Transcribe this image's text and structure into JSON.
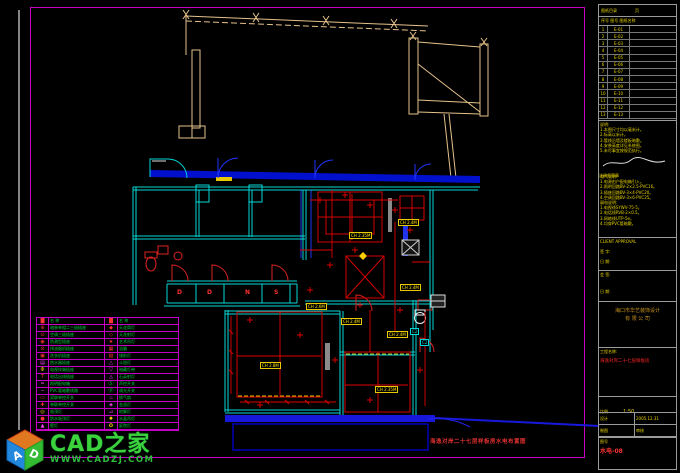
{
  "watermark": {
    "brand": "CAD之家",
    "url": "WWW.CADZJ.COM",
    "cube_letter_a": "A",
    "cube_letter_d": "D"
  },
  "drawing_title": "海逸对岸二十七层样板房水电布置图",
  "colors": {
    "frame": "#c400c4",
    "wall": "#00d8d8",
    "band": "#0010cc",
    "wiring": "#e00000",
    "label": "#ffe400",
    "legend_text": "#00cc44",
    "title_text": "#e8d400",
    "alert": "#ff2525",
    "roof": "#e6c28c"
  },
  "plan": {
    "ch_labels": [
      {
        "x": 349,
        "y": 232,
        "text": "CH 2.35M"
      },
      {
        "x": 398,
        "y": 219,
        "text": "CH 2.4M"
      },
      {
        "x": 400,
        "y": 284,
        "text": "CH 2.4M"
      },
      {
        "x": 260,
        "y": 362,
        "text": "CH 2.8M"
      },
      {
        "x": 375,
        "y": 386,
        "text": "CH 2.35M"
      },
      {
        "x": 306,
        "y": 303,
        "text": "CH 2.6M"
      },
      {
        "x": 341,
        "y": 318,
        "text": "CH 2.4M"
      },
      {
        "x": 387,
        "y": 331,
        "text": "CH 2.4M"
      }
    ],
    "closet_letters": [
      {
        "x": 177,
        "y": 290,
        "ch": "D"
      },
      {
        "x": 207,
        "y": 290,
        "ch": "D"
      },
      {
        "x": 245,
        "y": 290,
        "ch": "N"
      },
      {
        "x": 274,
        "y": 290,
        "ch": "S"
      }
    ],
    "c2_labels": [
      {
        "x": 410,
        "y": 328,
        "text": "C2"
      },
      {
        "x": 420,
        "y": 339,
        "text": "C2"
      }
    ]
  },
  "legend": {
    "header": {
      "sym": "█",
      "name": "名  称",
      "sym2": "█",
      "name2": "名  称"
    },
    "rows": [
      {
        "ls": "⊕",
        "lc": "#ff3333",
        "lt": "暗装单相二三极插座",
        "rs": "◆",
        "rc": "#ff3333",
        "rt": "天花筒灯"
      },
      {
        "ls": "⊙",
        "lc": "#ff3333",
        "lt": "空调三极插座",
        "rs": "◇",
        "rc": "#ff3333",
        "rt": "天花射灯"
      },
      {
        "ls": "◉",
        "lc": "#ff3333",
        "lt": "防溅型插座",
        "rs": "★",
        "rc": "#ff3333",
        "rt": "艺术吊灯"
      },
      {
        "ls": "⊘",
        "lc": "#ff3333",
        "lt": "排油烟机插座",
        "rs": "▦",
        "rc": "#ff3333",
        "rt": "浴霸"
      },
      {
        "ls": "▣",
        "lc": "#ff3333",
        "lt": "洗衣机插座",
        "rs": "▧",
        "rc": "#ff3333",
        "rt": "镜前灯"
      },
      {
        "ls": "▤",
        "lc": "#ff44ff",
        "lt": "热水器插座",
        "rs": "△",
        "rc": "#ff44ff",
        "rt": "斗胆灯"
      },
      {
        "ls": "Φ",
        "lc": "#ffd000",
        "lt": "电视终端插座",
        "rs": "▽",
        "rc": "#ff44ff",
        "rt": "暗藏灯带"
      },
      {
        "ls": "T",
        "lc": "#ff3333",
        "lt": "电话出线插座",
        "rs": "◬",
        "rc": "#ff44ff",
        "rt": "石英射灯"
      },
      {
        "ls": "═",
        "lc": "#ff44ff",
        "lt": "照明配电箱",
        "rs": "Ⓢ",
        "rc": "#00cc44",
        "rt": "声控开关"
      },
      {
        "ls": "─",
        "lc": "#ff44ff",
        "lt": "PVC管暗敷线路",
        "rs": "Ⓓ",
        "rc": "#00cc44",
        "rt": "调光开关"
      },
      {
        "ls": "▭",
        "lc": "#ff3333",
        "lt": "双联单控开关",
        "rs": "♨",
        "rc": "#ff44ff",
        "rt": "换气扇"
      },
      {
        "ls": "✚",
        "lc": "#ff3333",
        "lt": "单联单控开关",
        "rs": "◈",
        "rc": "#ff44ff",
        "rt": "金卤灯"
      },
      {
        "ls": "◎",
        "lc": "#ffd000",
        "lt": "吸顶灯",
        "rs": "⊿",
        "rc": "#ff44ff",
        "rt": "地脚灯"
      },
      {
        "ls": "●",
        "lc": "#ff3333",
        "lt": "防水吸顶灯",
        "rs": "✹",
        "rc": "#ffd000",
        "rt": "水晶吊灯"
      },
      {
        "ls": "▲",
        "lc": "#ff44ff",
        "lt": "壁灯",
        "rs": "✪",
        "rc": "#ffd000",
        "rt": "庭院灯"
      }
    ]
  },
  "title_block": {
    "rev_title": "图纸目录",
    "rev_page": "页",
    "rev_cols": "序号  图号  图纸名称",
    "rev_rows": [
      {
        "no": "1",
        "code": "E-01"
      },
      {
        "no": "2",
        "code": "E-02"
      },
      {
        "no": "3",
        "code": "E-03"
      },
      {
        "no": "4",
        "code": "E-04"
      },
      {
        "no": "5",
        "code": "E-05"
      },
      {
        "no": "6",
        "code": "E-06"
      },
      {
        "no": "7",
        "code": "E-07"
      },
      {
        "no": "8",
        "code": "E-08"
      },
      {
        "no": "9",
        "code": "E-09"
      },
      {
        "no": "10",
        "code": "E-10"
      },
      {
        "no": "11",
        "code": "E-11"
      },
      {
        "no": "12",
        "code": "E-12"
      },
      {
        "no": "13",
        "code": "E-13"
      }
    ],
    "notes": [
      "说明:",
      "1.本图尺寸均以毫米计。",
      "2.标高以米计。",
      "3.管线沿墙及楼板暗敷。",
      "4.安装高度详见系统图。",
      "5.未尽事宜按规范执行。"
    ],
    "sig_caption": "注册师签章",
    "specs": [
      "电气说明:",
      "1.电源由户配电箱引入。",
      "2.照明回路BV-2×2.5-PVC16。",
      "3.插座回路BV-3×4-PVC20。",
      "4.空调回路BV-3×6-PVC25。",
      "弱电说明:",
      "1.电视线SYWV-75-5。",
      "2.电话线RVB-2×0.5。",
      "3.网络线UTP-5e。",
      "4.均穿PVC管暗敷。"
    ],
    "approval_label": "CLIENT APPROVAL",
    "approval_sign": "签 字:",
    "approval_date": "日 期:",
    "cosign_label": "会 签:",
    "cosign_date": "日 期:",
    "company_line1": "海口市华艺装饰设计",
    "company_line2": "有 限 公 司",
    "project_label": "工程名称:",
    "project_value": "海逸对岸二十七层样板房",
    "scale_label": "比例",
    "scale_value": "1:50",
    "cells": {
      "design_label": "设计",
      "date_label": "日期",
      "date_value": "2005.12.31",
      "draft_label": "制图",
      "check_label": "审核"
    },
    "sheet_label": "图号",
    "sheet_value": "水电-08"
  }
}
